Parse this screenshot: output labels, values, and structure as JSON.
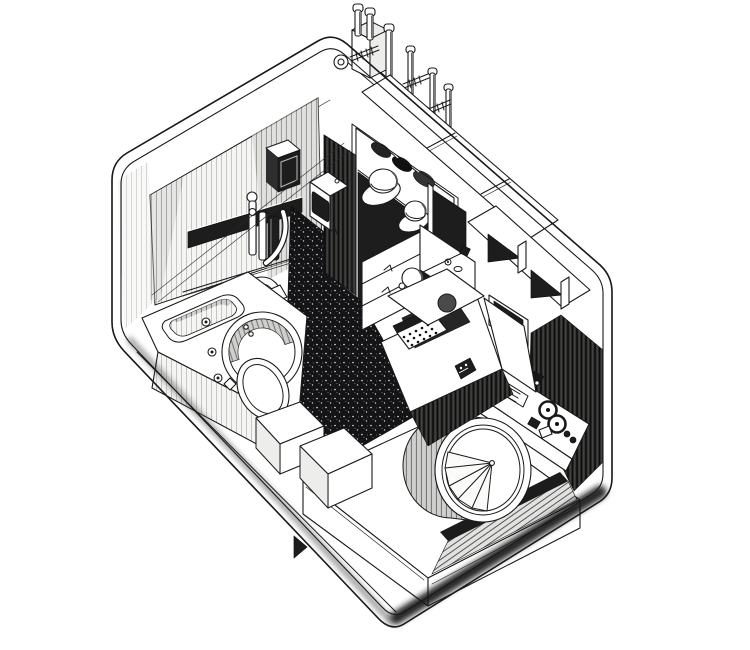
{
  "figure": {
    "title": "Capsule dwelling interior — axonometric cutaway drawing",
    "description": "Black-and-white pen-and-ink cutaway axonometric illustration of a prefabricated capsule living unit seen from above: a unit bathroom with sink and round basin at the left, a wardrobe with hats and folded clothes on the rear wall, closed cabinets and open shelf cubbies with a built-in TV along the right wall, a fold-down desk with typewriter, an audio control panel with reel-to-reel tape deck, a wide bed in the foreground, a large circular porthole window with a folding fan blind, a dark speckled carpet floor, and service pipes with threaded anchor bolts on the roof.",
    "medium": "technical line illustration on white background"
  },
  "palette": {
    "paper": "#ffffff",
    "ink": "#1a1a1a",
    "carpet": "#131313",
    "shadow": "#262626",
    "midtone": "#8f8f8f",
    "light_hatch": "#d9d9d8"
  },
  "parts": {
    "shell": "capsule outer shell with rounded corners",
    "roof_utilities": "rooftop service pipes and threaded anchor bolts",
    "bathroom": "unit bathroom: shower wall, mixer column, sink, round basin with seat",
    "wardrobe": "wardrobe niche with two hats and folded clothes",
    "right_storage": "closed cabinets, open shelf cubbies and TV niche",
    "desk": "fold-down desk with typewriter and task lamp",
    "audio_panel": "control panel with reel-to-reel tape deck, sliders and knobs",
    "bed": "wide bed with step boxes at its foot",
    "porthole_window": "circular window with folding fan blind",
    "carpet": "dark speckled carpet floor"
  }
}
